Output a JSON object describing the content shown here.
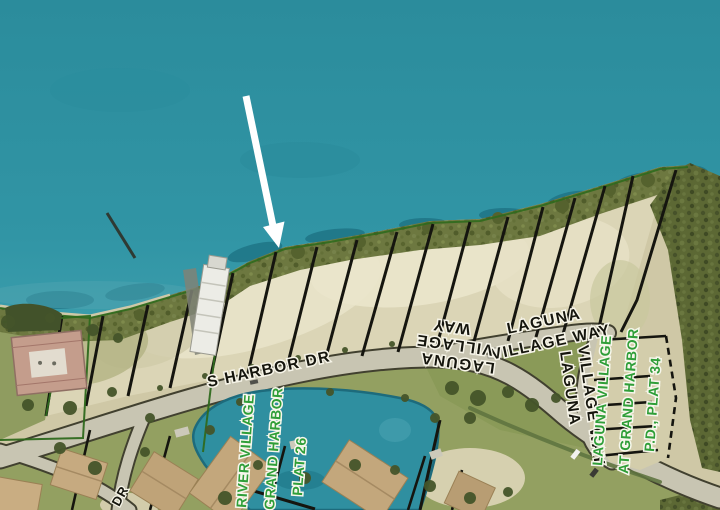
{
  "labels": {
    "s_harbor_dr": "S HARBOR DR",
    "dr_fragment": "DR",
    "laguna_village_way_horizontal": {
      "line1": "LAGUNA",
      "line2": "VILLAGE WAY"
    },
    "laguna_village_way_vertical": {
      "line1": "LAGUNA",
      "line2": "VILLAGE WAY"
    },
    "laguna_village_way_inverted": {
      "line1": "WAY",
      "line2": "VILLAGE",
      "line3": "LAGUNA"
    },
    "river_village_plat": {
      "line1": "RIVER VILLAGE",
      "line2": "GRAND HARBOR",
      "line3": "PLAT 26"
    },
    "laguna_village_plat": {
      "line1": "LAGUNA VILLAGE",
      "line2": "AT GRAND HARBOR",
      "line3": "P.D., PLAT 34"
    }
  },
  "colors": {
    "water": "#2f93a3",
    "shore_vegetation": "#6d7840",
    "dense_vegetation": "#5c6834",
    "lot_sand": "#dbd5b6",
    "grass": "#93a061",
    "road": "#c8c5b2",
    "lot_line": "#15150f",
    "plat_boundary_green": "#2f6a1d",
    "plat_text_green": "#2f9e38",
    "street_text": "#15150d",
    "arrow": "#ffffff"
  }
}
